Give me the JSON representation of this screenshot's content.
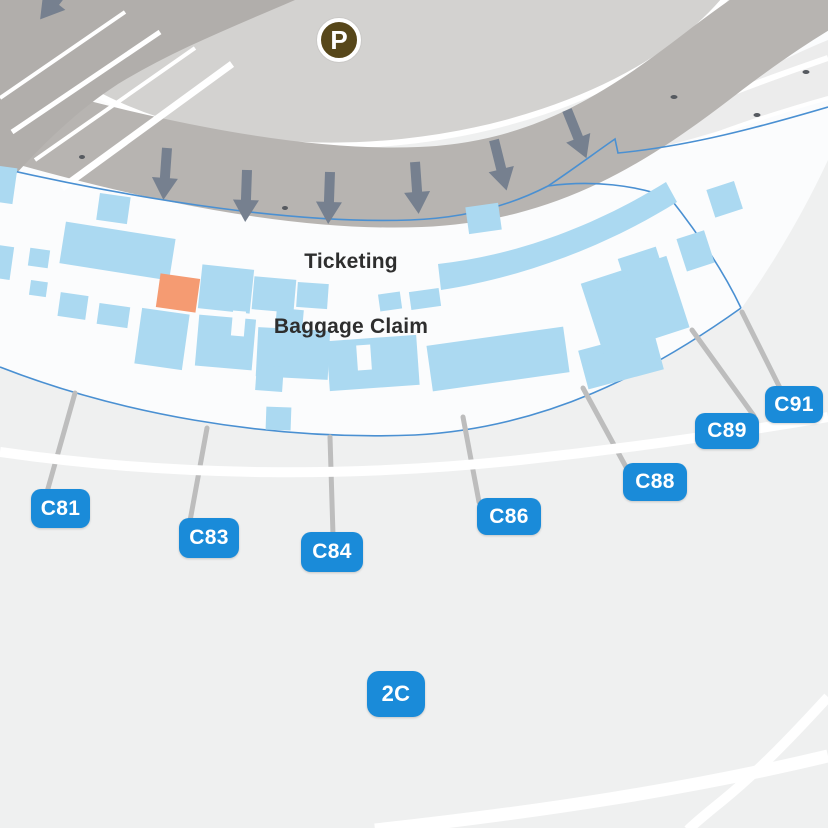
{
  "parking": {
    "symbol": "P"
  },
  "areas": {
    "ticketing_label": "Ticketing",
    "baggage_label": "Baggage Claim"
  },
  "terminal": {
    "badge": "2C"
  },
  "gates": [
    {
      "label": "C81"
    },
    {
      "label": "C83"
    },
    {
      "label": "C84"
    },
    {
      "label": "C86"
    },
    {
      "label": "C88"
    },
    {
      "label": "C89"
    },
    {
      "label": "C91"
    }
  ],
  "colors": {
    "badge_blue": "#1A8BD9",
    "outline_blue": "#4A90D2",
    "room_blue": "#ABD9F1",
    "highlight_orange": "#F59B72",
    "road_gray": "#B7B4B1",
    "parking_lot_gray": "#D3D2D0",
    "dark_road_gray": "#B1AEAB",
    "arrow_slate": "#76808F",
    "parking_brown": "#57471A",
    "apron_gray": "#EFF0F0"
  }
}
